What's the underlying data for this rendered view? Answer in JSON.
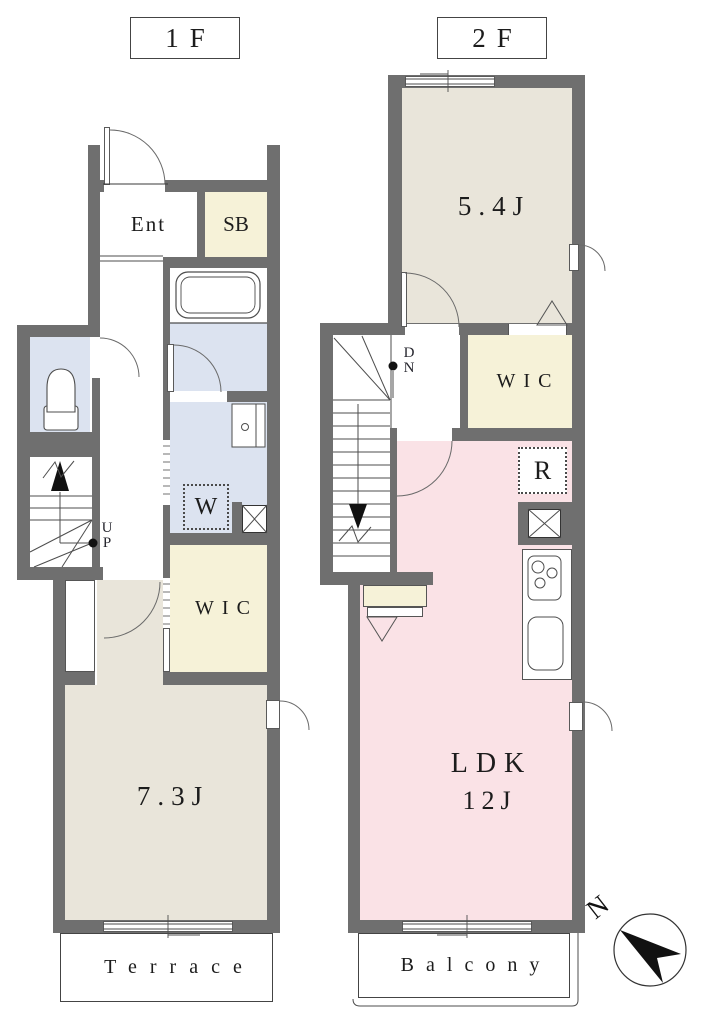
{
  "floor1": {
    "label": "1F",
    "entrance": "Ent",
    "shoe_box": "SB",
    "washer": "W",
    "closet": "WIC",
    "bedroom": "7.3J",
    "stairs_up": "UP",
    "terrace": "Terrace"
  },
  "floor2": {
    "label": "2F",
    "bedroom": "5.4J",
    "closet": "WIC",
    "fridge": "R",
    "living": "LDK",
    "living_size": "12J",
    "stairs_down": "DN",
    "balcony": "Balcony"
  },
  "compass": {
    "north": "N"
  },
  "colors": {
    "wall": "#6f6f6f",
    "room_beige": "#e9e5da",
    "closet_cream": "#f6f2d8",
    "wet_area_blue": "#dce3f0",
    "ldk_pink": "#fae2e6",
    "line": "#4d4d4d"
  }
}
